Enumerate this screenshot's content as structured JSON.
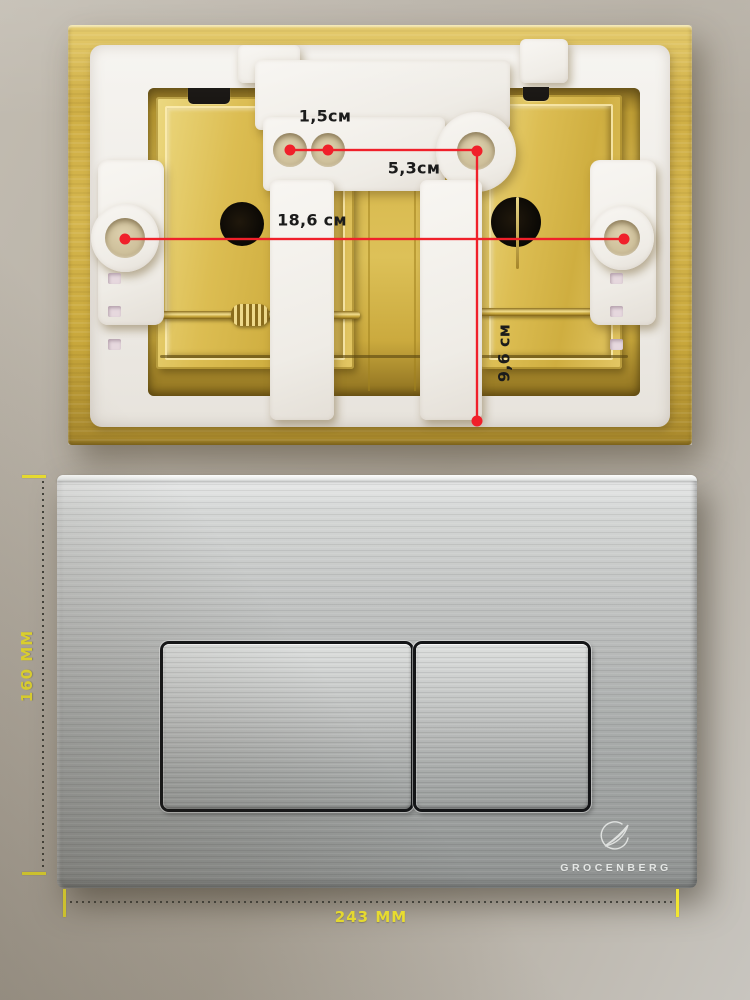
{
  "back_view": {
    "annotations": {
      "small_hole_gap": "1,5см",
      "hole_spacing": "5,3см",
      "mount_hole_spacing": "18,6 см",
      "vertical_offset": "9,6 см"
    },
    "line_color": "#f0202a",
    "plate_color": "#d5b64e"
  },
  "front_view": {
    "brand": "GROCENBERG",
    "monogram_icon": "grocenberg-monogram-icon",
    "width_label": "243 MM",
    "height_label": "160 MM",
    "annotation_color": "#f2e630",
    "plate_finish_color": "#b8bab9"
  }
}
